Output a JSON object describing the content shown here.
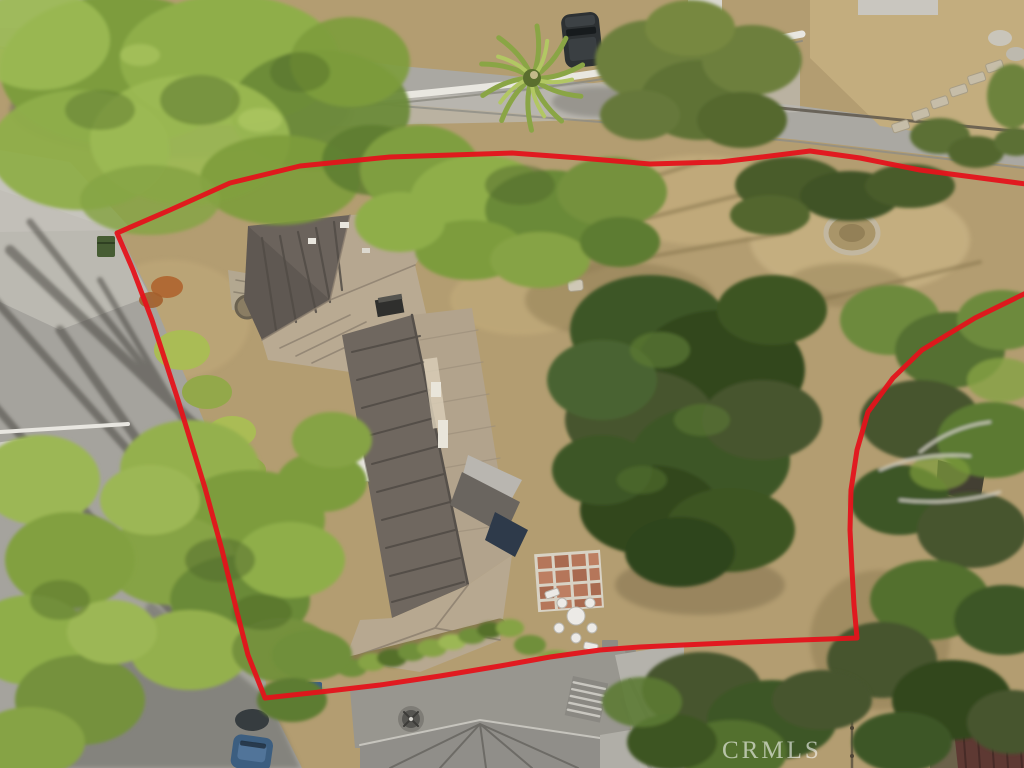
{
  "canvas": {
    "width": 1024,
    "height": 768
  },
  "watermark": {
    "text": "CRMLS",
    "color": "rgba(255,255,255,0.58)"
  },
  "boundary": {
    "color": "#e4131b",
    "stroke_width": 5,
    "opacity": 0.95,
    "points": [
      [
        1026,
        293
      ],
      [
        975,
        318
      ],
      [
        922,
        350
      ],
      [
        893,
        378
      ],
      [
        868,
        412
      ],
      [
        857,
        450
      ],
      [
        851,
        490
      ],
      [
        850,
        530
      ],
      [
        852,
        570
      ],
      [
        854,
        605
      ],
      [
        857,
        638
      ],
      [
        800,
        640
      ],
      [
        750,
        642
      ],
      [
        683,
        645
      ],
      [
        640,
        647
      ],
      [
        600,
        650
      ],
      [
        550,
        657
      ],
      [
        500,
        666
      ],
      [
        440,
        676
      ],
      [
        380,
        685
      ],
      [
        320,
        692
      ],
      [
        265,
        698
      ],
      [
        248,
        655
      ],
      [
        237,
        612
      ],
      [
        222,
        550
      ],
      [
        205,
        488
      ],
      [
        178,
        400
      ],
      [
        152,
        320
      ],
      [
        133,
        270
      ],
      [
        117,
        233
      ],
      [
        170,
        210
      ],
      [
        230,
        183
      ],
      [
        300,
        166
      ],
      [
        390,
        157
      ],
      [
        512,
        153
      ],
      [
        580,
        158
      ],
      [
        650,
        164
      ],
      [
        720,
        162
      ],
      [
        762,
        157
      ],
      [
        810,
        151
      ],
      [
        860,
        158
      ],
      [
        920,
        170
      ],
      [
        1026,
        184
      ]
    ]
  }
}
